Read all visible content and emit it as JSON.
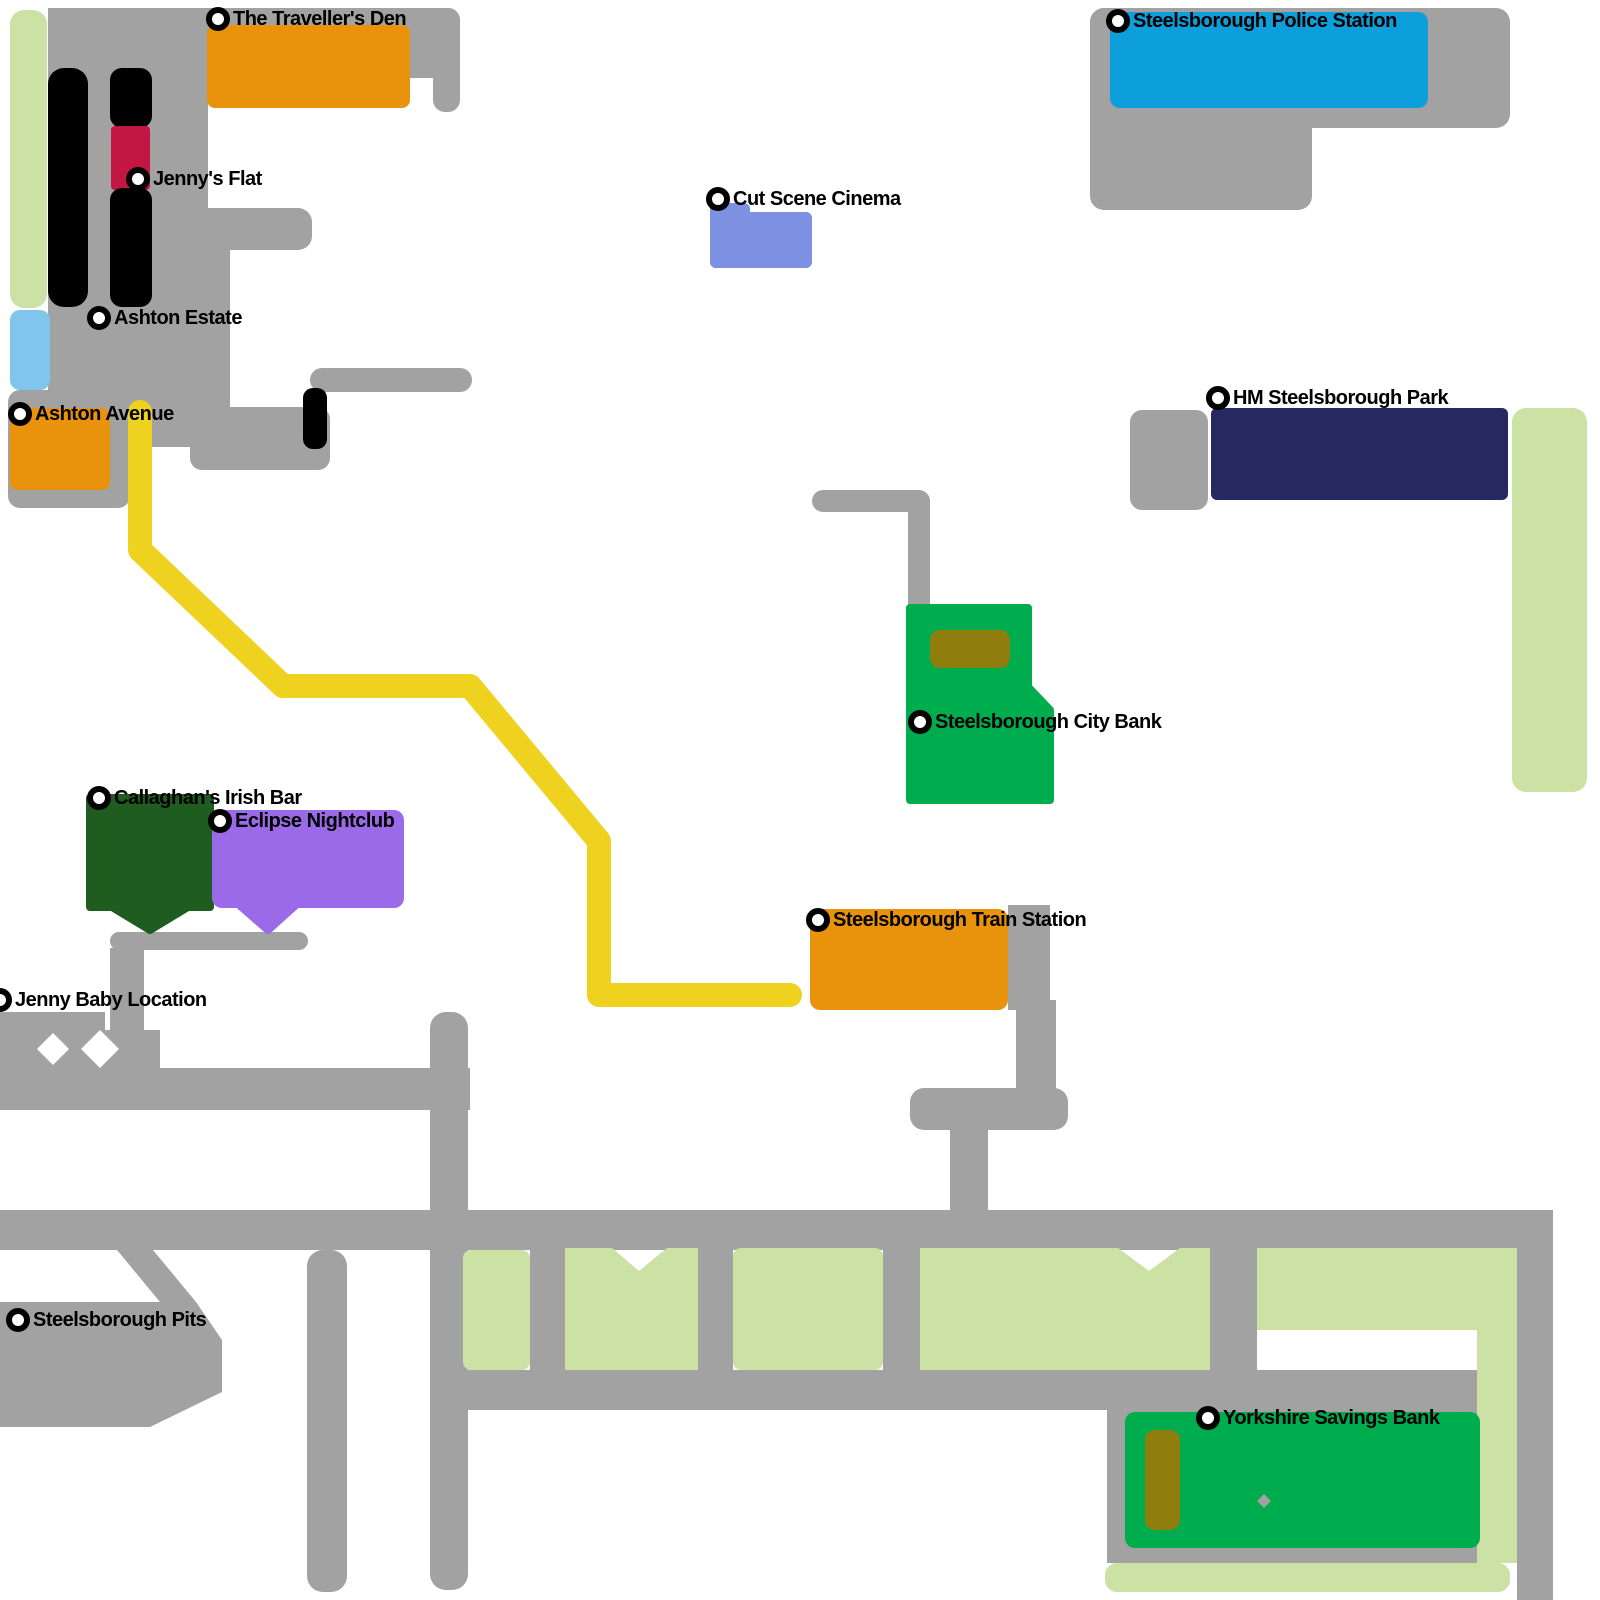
{
  "colors": {
    "gray": "#A2A2A2",
    "paleGreen": "#CCE2A5",
    "lightBlue": "#7FC5EC",
    "orange": "#E8930B",
    "policeBlue": "#0D9FDB",
    "periwinkle": "#7E90E2",
    "navy": "#26295F",
    "green": "#00AD4E",
    "olive": "#8F7D0E",
    "darkGreen": "#1F5C1F",
    "purple": "#9A6AE8",
    "crimson": "#C31643",
    "yellow": "#EFD11F",
    "black": "#000000",
    "white": "#FFFFFF"
  },
  "markers": [
    {
      "id": "travellers-den",
      "label": "The Traveller's Den",
      "x": 218,
      "y": 19
    },
    {
      "id": "police-station",
      "label": "Steelsborough Police Station",
      "x": 1118,
      "y": 21
    },
    {
      "id": "jennys-flat",
      "label": "Jenny's Flat",
      "x": 138,
      "y": 179
    },
    {
      "id": "cut-scene-cinema",
      "label": "Cut Scene Cinema",
      "x": 718,
      "y": 199
    },
    {
      "id": "ashton-estate",
      "label": "Ashton Estate",
      "x": 99,
      "y": 318
    },
    {
      "id": "ashton-avenue",
      "label": "Ashton Avenue",
      "x": 20,
      "y": 414
    },
    {
      "id": "hm-park",
      "label": "HM Steelsborough Park",
      "x": 1218,
      "y": 398
    },
    {
      "id": "city-bank",
      "label": "Steelsborough City Bank",
      "x": 920,
      "y": 722
    },
    {
      "id": "callaghans-irish-bar",
      "label": "Callaghan's Irish Bar",
      "x": 99,
      "y": 798
    },
    {
      "id": "eclipse-nightclub",
      "label": "Eclipse Nightclub",
      "x": 220,
      "y": 821
    },
    {
      "id": "train-station",
      "label": "Steelsborough Train Station",
      "x": 818,
      "y": 920
    },
    {
      "id": "jenny-baby-location",
      "label": "Jenny Baby Location",
      "x": 0,
      "y": 1000
    },
    {
      "id": "steelsborough-pits",
      "label": "Steelsborough Pits",
      "x": 18,
      "y": 1320
    },
    {
      "id": "yorkshire-savings-bank",
      "label": "Yorkshire Savings Bank",
      "x": 1208,
      "y": 1418
    }
  ],
  "roads": [
    {
      "n": "road-top-band",
      "c": "gray",
      "x": 48,
      "y": 8,
      "w": 412,
      "h": 70,
      "r": 12
    },
    {
      "n": "road-top-right-stub",
      "c": "gray",
      "x": 433,
      "y": 8,
      "w": 27,
      "h": 104,
      "r": 12
    },
    {
      "n": "road-estate-left-block",
      "c": "gray",
      "x": 48,
      "y": 8,
      "w": 160,
      "h": 322,
      "r": 0
    },
    {
      "n": "road-estate-mid",
      "c": "gray",
      "x": 48,
      "y": 208,
      "w": 182,
      "h": 199,
      "r": 0
    },
    {
      "n": "road-avenue-plaza",
      "c": "gray",
      "x": 8,
      "y": 390,
      "w": 122,
      "h": 118,
      "r": 12
    },
    {
      "n": "road-avenue-mid",
      "c": "gray",
      "x": 110,
      "y": 390,
      "w": 120,
      "h": 57,
      "r": 0
    },
    {
      "n": "road-estate-lower-band",
      "c": "gray",
      "x": 190,
      "y": 407,
      "w": 140,
      "h": 63,
      "r": 12
    },
    {
      "n": "road-estate-stub",
      "c": "gray",
      "x": 207,
      "y": 208,
      "w": 105,
      "h": 42,
      "r": 14
    },
    {
      "n": "road-thin-east",
      "c": "gray",
      "x": 310,
      "y": 368,
      "w": 162,
      "h": 24,
      "r": 12
    },
    {
      "n": "road-police-plaza-top",
      "c": "gray",
      "x": 1090,
      "y": 8,
      "w": 420,
      "h": 120,
      "r": 14
    },
    {
      "n": "road-police-plaza-left",
      "c": "gray",
      "x": 1090,
      "y": 8,
      "w": 222,
      "h": 202,
      "r": 14
    },
    {
      "n": "road-park-square",
      "c": "gray",
      "x": 1130,
      "y": 410,
      "w": 78,
      "h": 100,
      "r": 12
    },
    {
      "n": "road-bank-horizontal",
      "c": "gray",
      "x": 812,
      "y": 490,
      "w": 118,
      "h": 22,
      "r": 11
    },
    {
      "n": "road-bank-vertical",
      "c": "gray",
      "x": 908,
      "y": 500,
      "w": 22,
      "h": 110,
      "r": 0
    },
    {
      "n": "road-station-side",
      "c": "gray",
      "x": 1008,
      "y": 905,
      "w": 42,
      "h": 105,
      "r": 0
    },
    {
      "n": "road-station-drop",
      "c": "gray",
      "x": 1016,
      "y": 1000,
      "w": 40,
      "h": 95,
      "r": 0
    },
    {
      "n": "road-station-bar",
      "c": "gray",
      "x": 910,
      "y": 1088,
      "w": 158,
      "h": 42,
      "r": 14
    },
    {
      "n": "road-station-stem",
      "c": "gray",
      "x": 950,
      "y": 1130,
      "w": 38,
      "h": 85,
      "r": 0
    },
    {
      "n": "road-bar-row",
      "c": "gray",
      "x": 110,
      "y": 932,
      "w": 198,
      "h": 18,
      "r": 9
    },
    {
      "n": "road-bar-vertical",
      "c": "gray",
      "x": 110,
      "y": 948,
      "w": 34,
      "h": 122,
      "r": 0
    },
    {
      "n": "road-junction-band",
      "c": "gray",
      "x": 0,
      "y": 1012,
      "w": 105,
      "h": 20,
      "r": 0
    },
    {
      "n": "road-junction-cross",
      "c": "gray",
      "x": 0,
      "y": 1030,
      "w": 160,
      "h": 38,
      "r": 0
    },
    {
      "n": "road-mid-horizontal",
      "c": "gray",
      "x": 0,
      "y": 1068,
      "w": 470,
      "h": 42,
      "r": 0
    },
    {
      "n": "road-connector-vertical",
      "c": "gray",
      "x": 430,
      "y": 1012,
      "w": 38,
      "h": 578,
      "r": 16
    },
    {
      "n": "road-main-horizontal",
      "c": "gray",
      "x": 0,
      "y": 1210,
      "w": 1553,
      "h": 40,
      "r": 0
    },
    {
      "n": "road-right-vertical",
      "c": "gray",
      "x": 1517,
      "y": 1210,
      "w": 36,
      "h": 390,
      "r": 0
    },
    {
      "n": "road-south-stub",
      "c": "gray",
      "x": 307,
      "y": 1250,
      "w": 40,
      "h": 342,
      "r": 16
    },
    {
      "n": "road-pits-blob",
      "c": "gray",
      "poly": [
        [
          0,
          1302
        ],
        [
          196,
          1302
        ],
        [
          222,
          1340
        ],
        [
          222,
          1392
        ],
        [
          150,
          1427
        ],
        [
          0,
          1427
        ]
      ]
    },
    {
      "n": "road-pits-link",
      "c": "gray",
      "poly": [
        [
          117,
          1250
        ],
        [
          153,
          1250
        ],
        [
          196,
          1302
        ],
        [
          160,
          1302
        ]
      ]
    },
    {
      "n": "road-lower-band",
      "c": "gray",
      "x": 463,
      "y": 1370,
      "w": 1054,
      "h": 40,
      "r": 0
    },
    {
      "n": "road-bank-plaza",
      "c": "gray",
      "x": 1107,
      "y": 1408,
      "w": 370,
      "h": 155,
      "r": 0
    },
    {
      "n": "road-block-gap-4",
      "c": "gray",
      "x": 1210,
      "y": 1248,
      "w": 47,
      "h": 122,
      "r": 0
    },
    {
      "n": "road-block-gap-1",
      "c": "gray",
      "x": 530,
      "y": 1250,
      "w": 35,
      "h": 120,
      "r": 0
    },
    {
      "n": "road-block-gap-2",
      "c": "gray",
      "x": 698,
      "y": 1248,
      "w": 35,
      "h": 122,
      "r": 0
    },
    {
      "n": "road-block-gap-3",
      "c": "gray",
      "x": 883,
      "y": 1248,
      "w": 37,
      "h": 122,
      "r": 0
    }
  ],
  "cutouts": [
    {
      "n": "junction-diamond-1",
      "c": "white",
      "poly": [
        [
          53,
          1033
        ],
        [
          69,
          1049
        ],
        [
          53,
          1065
        ],
        [
          37,
          1049
        ]
      ]
    },
    {
      "n": "junction-diamond-2",
      "c": "white",
      "poly": [
        [
          100,
          1030
        ],
        [
          119,
          1049
        ],
        [
          100,
          1068
        ],
        [
          81,
          1049
        ]
      ]
    }
  ],
  "zones": [
    {
      "n": "green-strip-west",
      "c": "paleGreen",
      "x": 10,
      "y": 10,
      "w": 37,
      "h": 298,
      "r": 14
    },
    {
      "n": "water-block",
      "c": "lightBlue",
      "x": 10,
      "y": 310,
      "w": 40,
      "h": 80,
      "r": 10
    },
    {
      "n": "green-block-1",
      "c": "paleGreen",
      "x": 463,
      "y": 1250,
      "w": 67,
      "h": 120,
      "r": 8
    },
    {
      "n": "green-block-2",
      "c": "paleGreen",
      "poly": [
        [
          565,
          1248
        ],
        [
          612,
          1248
        ],
        [
          639,
          1271
        ],
        [
          667,
          1248
        ],
        [
          698,
          1248
        ],
        [
          698,
          1370
        ],
        [
          565,
          1370
        ]
      ]
    },
    {
      "n": "green-block-3",
      "c": "paleGreen",
      "x": 733,
      "y": 1248,
      "w": 150,
      "h": 122,
      "r": 8
    },
    {
      "n": "green-block-4",
      "c": "paleGreen",
      "poly": [
        [
          920,
          1248
        ],
        [
          1118,
          1248
        ],
        [
          1149,
          1271
        ],
        [
          1180,
          1248
        ],
        [
          1210,
          1248
        ],
        [
          1210,
          1370
        ],
        [
          920,
          1370
        ]
      ]
    },
    {
      "n": "green-block-5",
      "c": "paleGreen",
      "poly": [
        [
          1257,
          1248
        ],
        [
          1517,
          1248
        ],
        [
          1517,
          1563
        ],
        [
          1477,
          1563
        ],
        [
          1477,
          1330
        ],
        [
          1257,
          1330
        ]
      ]
    },
    {
      "n": "green-strip-east",
      "c": "paleGreen",
      "x": 1512,
      "y": 408,
      "w": 75,
      "h": 384,
      "r": 14
    },
    {
      "n": "green-strip-south",
      "c": "paleGreen",
      "x": 1105,
      "y": 1563,
      "w": 405,
      "h": 29,
      "r": 12
    }
  ],
  "buildings": [
    {
      "n": "building-travellers-den",
      "c": "orange",
      "x": 207,
      "y": 25,
      "w": 203,
      "h": 83,
      "r": 8
    },
    {
      "n": "building-police-station",
      "c": "policeBlue",
      "x": 1110,
      "y": 12,
      "w": 318,
      "h": 96,
      "r": 10
    },
    {
      "n": "building-cinema-upper",
      "c": "periwinkle",
      "x": 710,
      "y": 203,
      "w": 40,
      "h": 65,
      "r": 6
    },
    {
      "n": "building-cinema-main",
      "c": "periwinkle",
      "x": 710,
      "y": 212,
      "w": 102,
      "h": 56,
      "r": 6
    },
    {
      "n": "building-park",
      "c": "navy",
      "x": 1211,
      "y": 408,
      "w": 297,
      "h": 92,
      "r": 6
    },
    {
      "n": "building-city-bank",
      "c": "green",
      "poly": [
        [
          910,
          608
        ],
        [
          1028,
          608
        ],
        [
          1028,
          687
        ],
        [
          1050,
          710
        ],
        [
          1050,
          800
        ],
        [
          910,
          800
        ]
      ],
      "rj": true
    },
    {
      "n": "building-city-bank-roof",
      "c": "olive",
      "x": 930,
      "y": 630,
      "w": 80,
      "h": 38,
      "r": 10
    },
    {
      "n": "building-ashton-avenue",
      "c": "orange",
      "x": 10,
      "y": 408,
      "w": 100,
      "h": 82,
      "r": 8
    },
    {
      "n": "building-callaghans-bar",
      "c": "darkGreen",
      "poly": [
        [
          90,
          798
        ],
        [
          210,
          798
        ],
        [
          210,
          907
        ],
        [
          188,
          907
        ],
        [
          150,
          930
        ],
        [
          112,
          907
        ],
        [
          90,
          907
        ]
      ],
      "rj": true
    },
    {
      "n": "building-eclipse-nightclub",
      "c": "purple",
      "x": 212,
      "y": 810,
      "w": 192,
      "h": 98,
      "r": 10
    },
    {
      "n": "building-eclipse-tab",
      "c": "purple",
      "poly": [
        [
          237,
          903
        ],
        [
          298,
          903
        ],
        [
          268,
          930
        ]
      ],
      "rj": true
    },
    {
      "n": "building-train-station",
      "c": "orange",
      "x": 810,
      "y": 909,
      "w": 198,
      "h": 101,
      "r": 10
    },
    {
      "n": "building-yorkshire-bank",
      "c": "green",
      "x": 1125,
      "y": 1412,
      "w": 355,
      "h": 136,
      "r": 10
    },
    {
      "n": "building-yorkshire-bank-roof",
      "c": "olive",
      "x": 1145,
      "y": 1430,
      "w": 35,
      "h": 100,
      "r": 10
    },
    {
      "n": "bank-plaza-diamond",
      "c": "gray",
      "poly": [
        [
          1264,
          1494
        ],
        [
          1271,
          1501
        ],
        [
          1264,
          1508
        ],
        [
          1257,
          1501
        ]
      ]
    },
    {
      "n": "tower-1",
      "c": "black",
      "x": 48,
      "y": 68,
      "w": 40,
      "h": 239,
      "r": 16
    },
    {
      "n": "tower-2-upper",
      "c": "black",
      "x": 110,
      "y": 68,
      "w": 42,
      "h": 60,
      "r": 12
    },
    {
      "n": "jennys-flat-block",
      "c": "crimson",
      "x": 111,
      "y": 126,
      "w": 39,
      "h": 64,
      "r": 4
    },
    {
      "n": "tower-2-lower",
      "c": "black",
      "x": 110,
      "y": 188,
      "w": 42,
      "h": 119,
      "r": 12
    },
    {
      "n": "black-kiosk",
      "c": "black",
      "x": 303,
      "y": 388,
      "w": 24,
      "h": 61,
      "r": 10
    }
  ],
  "route": {
    "n": "highlighted-route",
    "c": "yellow",
    "width": 24,
    "points": [
      [
        140,
        412
      ],
      [
        140,
        550
      ],
      [
        283,
        686
      ],
      [
        470,
        686
      ],
      [
        599,
        841
      ],
      [
        599,
        995
      ],
      [
        790,
        995
      ]
    ]
  }
}
